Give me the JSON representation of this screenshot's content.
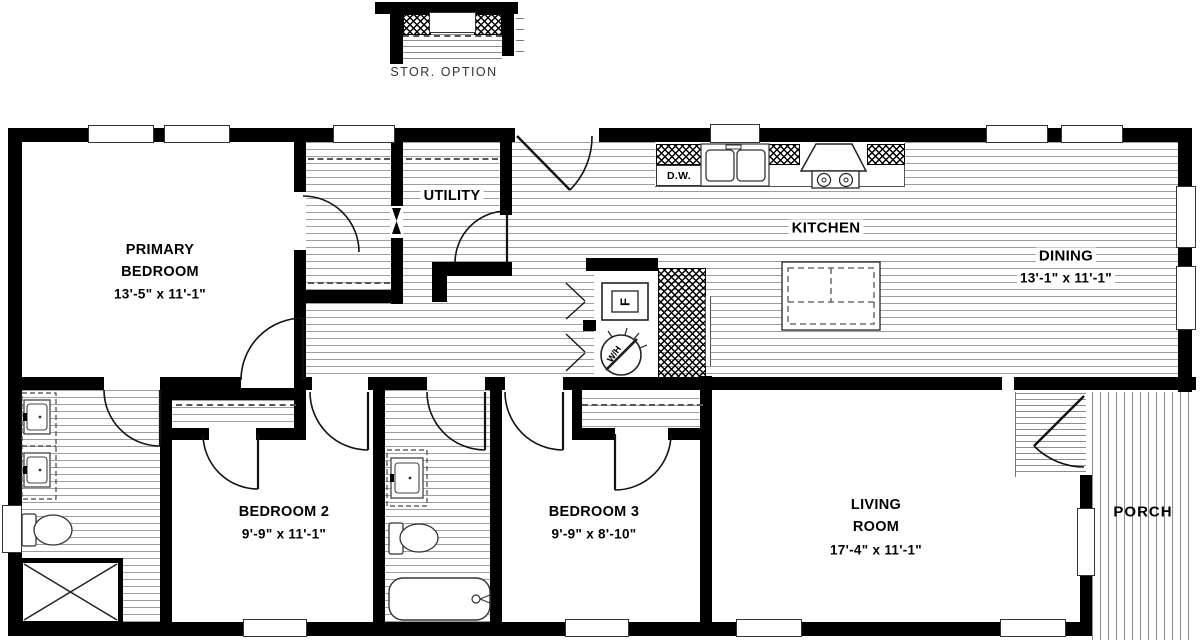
{
  "storage": {
    "label": "STOR. OPTION"
  },
  "rooms": {
    "primary_bedroom": {
      "name_line1": "PRIMARY",
      "name_line2": "BEDROOM",
      "dims": "13'-5\" x 11'-1\""
    },
    "utility": {
      "name": "UTILITY"
    },
    "kitchen": {
      "name": "KITCHEN"
    },
    "dining": {
      "name": "DINING",
      "dims": "13'-1\" x 11'-1\""
    },
    "bedroom2": {
      "name": "BEDROOM 2",
      "dims": "9'-9\" x 11'-1\""
    },
    "bedroom3": {
      "name": "BEDROOM 3",
      "dims": "9'-9\" x 8'-10\""
    },
    "living_room": {
      "name_line1": "LIVING",
      "name_line2": "ROOM",
      "dims": "17'-4\" x 11'-1\""
    },
    "porch": {
      "name": "PORCH"
    }
  },
  "fixtures": {
    "dishwasher": "D.W.",
    "furnace": "F",
    "water_heater": "W/H"
  },
  "colors": {
    "wall": "#000000",
    "floor_line": "#9e9e9e",
    "background": "#ffffff"
  }
}
